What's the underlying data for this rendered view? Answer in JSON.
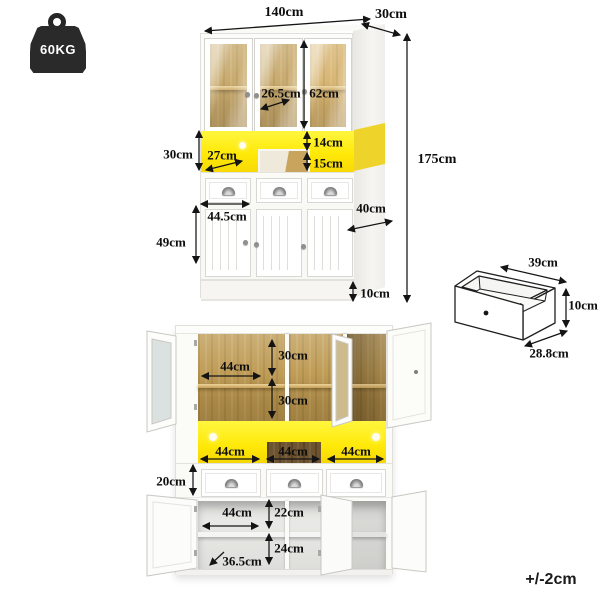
{
  "badges": {
    "weight": "60KG",
    "tolerance": "+/-2cm"
  },
  "front_view": {
    "overall_width": "140cm",
    "top_depth": "30cm",
    "overall_height": "175cm",
    "glass_inner_depth": "26.5cm",
    "glass_section_height": "62cm",
    "led_section_height": "30cm",
    "led_left_width": "27cm",
    "led_strip_height": "14cm",
    "open_shelf_height": "15cm",
    "cabinet_inner_width": "44.5cm",
    "door_section_height": "49cm",
    "base_depth": "40cm",
    "kickboard_height": "10cm"
  },
  "drawer_view": {
    "width": "39cm",
    "height": "10cm",
    "depth": "28.8cm"
  },
  "open_view": {
    "top_shelf_width": "44cm",
    "upper_shelf_height": "30cm",
    "lower_shelf_height": "30cm",
    "led_compartment_widths": [
      "44cm",
      "44cm",
      "44cm"
    ],
    "drawer_front_height": "20cm",
    "bottom_shelf_width": "44cm",
    "bottom_upper_height": "22cm",
    "bottom_lower_height": "24cm",
    "bottom_diagonal": "36.5cm"
  }
}
